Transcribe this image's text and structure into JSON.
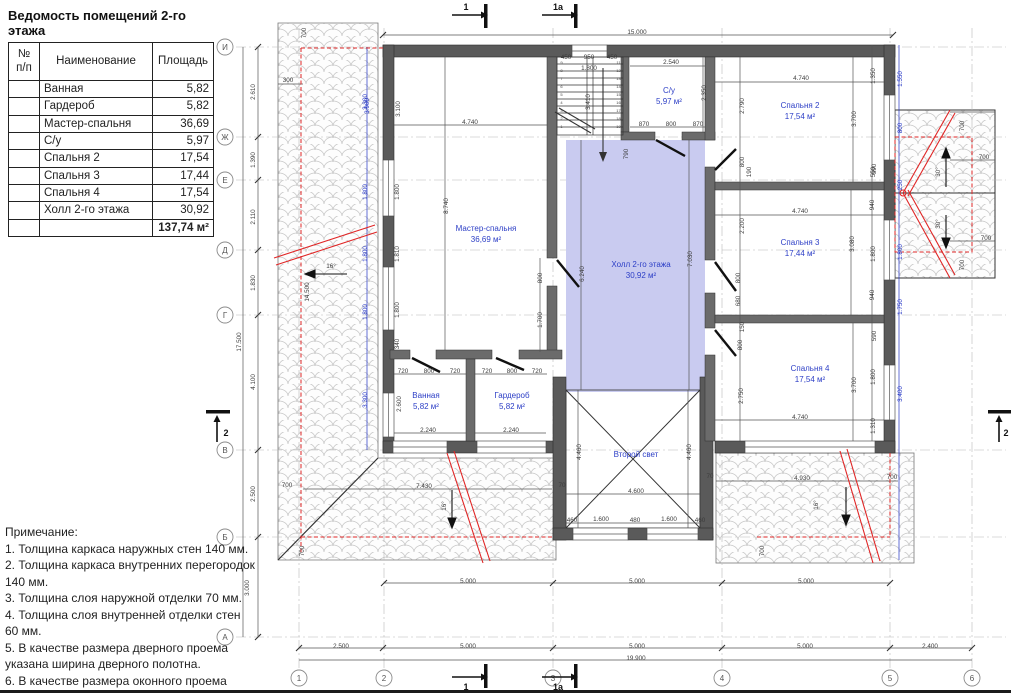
{
  "table": {
    "title": "Ведомость помещений 2-го этажа",
    "header": {
      "no": "№ п/п",
      "name": "Наименование",
      "area": "Площадь"
    },
    "rows": [
      {
        "name": "Ванная",
        "area": "5,82"
      },
      {
        "name": "Гардероб",
        "area": "5,82"
      },
      {
        "name": "Мастер-спальня",
        "area": "36,69"
      },
      {
        "name": "С/у",
        "area": "5,97"
      },
      {
        "name": "Спальня 2",
        "area": "17,54"
      },
      {
        "name": "Спальня 3",
        "area": "17,44"
      },
      {
        "name": "Спальня 4",
        "area": "17,54"
      },
      {
        "name": "Холл 2-го этажа",
        "area": "30,92"
      }
    ],
    "total": "137,74 м²"
  },
  "notes": {
    "title": "Примечание:",
    "items": [
      "1. Толщина каркаса наружных стен 140 мм.",
      "2. Толщина каркаса внутренних перегородок 140 мм.",
      "3. Толщина слоя наружной отделки 70 мм.",
      "4. Толщина слоя внутренней отделки стен 60 мм.",
      "5. В качестве размера дверного проема указана ширина дверного полотна.",
      "6. В качестве размера оконного проема указана ширина оконного блока."
    ]
  },
  "rooms": [
    {
      "name": "Мастер-спальня",
      "area": "36,69 м²"
    },
    {
      "name": "С/у",
      "area": "5,97 м²"
    },
    {
      "name": "Спальня 2",
      "area": "17,54 м²"
    },
    {
      "name": "Спальня 3",
      "area": "17,44 м²"
    },
    {
      "name": "Спальня 4",
      "area": "17,54 м²"
    },
    {
      "name": "Холл 2-го этажа",
      "area": "30,92 м²"
    },
    {
      "name": "Ванная",
      "area": "5,82 м²"
    },
    {
      "name": "Гардероб",
      "area": "5,82 м²"
    },
    {
      "name": "Второй свет",
      "area": ""
    }
  ],
  "axes": {
    "letters": [
      {
        "label": "И",
        "y": 47
      },
      {
        "label": "Ж",
        "y": 137
      },
      {
        "label": "Е",
        "y": 180
      },
      {
        "label": "Д",
        "y": 250
      },
      {
        "label": "Г",
        "y": 315
      },
      {
        "label": "В",
        "y": 450
      },
      {
        "label": "Б",
        "y": 537
      },
      {
        "label": "А",
        "y": 637
      }
    ],
    "numbers": [
      {
        "label": "1",
        "x": 299
      },
      {
        "label": "2",
        "x": 384
      },
      {
        "label": "3",
        "x": 553
      },
      {
        "label": "4",
        "x": 722
      },
      {
        "label": "5",
        "x": 890
      },
      {
        "label": "6",
        "x": 972
      }
    ]
  },
  "markers": [
    {
      "label": "1"
    },
    {
      "label": "1a"
    },
    {
      "label": "1"
    },
    {
      "label": "1a"
    },
    {
      "label": "2"
    },
    {
      "label": "2"
    }
  ],
  "stairs": {
    "left_numbers": [
      "9",
      "8",
      "7",
      "6",
      "5",
      "4",
      "3",
      "2",
      "1"
    ],
    "right_numbers": [
      "11",
      "12",
      "13",
      "14",
      "15",
      "16",
      "17",
      "18",
      "19"
    ]
  },
  "colors": {
    "wall": "#5a5a5a",
    "interior_wall": "#6b6b6b",
    "hall_fill": "#c9cbf0",
    "dim_text": "#3c3c3c",
    "blue_dim": "#2334c4",
    "red": "#e02626",
    "hatch": "#c8c8c8",
    "axis": "#b0b0b0",
    "room_text": "#2c3ec6"
  },
  "dims": [
    {
      "t": "15.000",
      "x": 637,
      "y": 32
    },
    {
      "t": "700",
      "x": 306,
      "y": 31,
      "r": -90
    },
    {
      "t": "300",
      "x": 288,
      "y": 80
    },
    {
      "t": "3.900",
      "x": 369,
      "y": 104,
      "r": -90,
      "c": "b"
    },
    {
      "t": "3.100",
      "x": 400,
      "y": 107,
      "r": -90
    },
    {
      "t": "4.740",
      "x": 470,
      "y": 122
    },
    {
      "t": "450",
      "x": 566,
      "y": 57
    },
    {
      "t": "950",
      "x": 589,
      "y": 57
    },
    {
      "t": "450",
      "x": 612,
      "y": 57
    },
    {
      "t": "1.800",
      "x": 589,
      "y": 68
    },
    {
      "t": "3.410",
      "x": 590,
      "y": 100,
      "r": -90
    },
    {
      "t": "790",
      "x": 628,
      "y": 152,
      "r": -90
    },
    {
      "t": "2.540",
      "x": 671,
      "y": 62
    },
    {
      "t": "2.350",
      "x": 706,
      "y": 91,
      "r": -90
    },
    {
      "t": "870",
      "x": 644,
      "y": 124
    },
    {
      "t": "800",
      "x": 671,
      "y": 124
    },
    {
      "t": "870",
      "x": 698,
      "y": 124
    },
    {
      "t": "4.740",
      "x": 801,
      "y": 78
    },
    {
      "t": "2.790",
      "x": 744,
      "y": 104,
      "r": -90
    },
    {
      "t": "3.700",
      "x": 856,
      "y": 117,
      "r": -90
    },
    {
      "t": "1.350",
      "x": 875,
      "y": 74,
      "r": -90
    },
    {
      "t": "550",
      "x": 875,
      "y": 170,
      "r": -90
    },
    {
      "t": "1.550",
      "x": 902,
      "y": 77,
      "r": -90,
      "c": "b"
    },
    {
      "t": "800",
      "x": 902,
      "y": 126,
      "r": -90,
      "c": "b"
    },
    {
      "t": "250",
      "x": 902,
      "y": 183,
      "r": -90,
      "c": "b"
    },
    {
      "t": "1.800",
      "x": 902,
      "y": 250,
      "r": -90,
      "c": "b"
    },
    {
      "t": "1.750",
      "x": 902,
      "y": 305,
      "r": -90,
      "c": "b"
    },
    {
      "t": "3.400",
      "x": 902,
      "y": 392,
      "r": -90,
      "c": "b"
    },
    {
      "t": "700",
      "x": 964,
      "y": 124,
      "r": -90
    },
    {
      "t": "700",
      "x": 984,
      "y": 157
    },
    {
      "t": "30°",
      "x": 940,
      "y": 170,
      "r": -90
    },
    {
      "t": "30°",
      "x": 940,
      "y": 222,
      "r": -90
    },
    {
      "t": "700",
      "x": 986,
      "y": 238
    },
    {
      "t": "700",
      "x": 964,
      "y": 263,
      "r": -90
    },
    {
      "t": "2.610",
      "x": 255,
      "y": 90,
      "r": -90
    },
    {
      "t": "1.390",
      "x": 255,
      "y": 158,
      "r": -90
    },
    {
      "t": "2.110",
      "x": 255,
      "y": 215,
      "r": -90
    },
    {
      "t": "1.830",
      "x": 255,
      "y": 281,
      "r": -90
    },
    {
      "t": "17.500",
      "x": 241,
      "y": 340,
      "r": -90
    },
    {
      "t": "4.100",
      "x": 255,
      "y": 380,
      "r": -90
    },
    {
      "t": "2.500",
      "x": 255,
      "y": 492,
      "r": -90
    },
    {
      "t": "3.000",
      "x": 249,
      "y": 586,
      "r": -90
    },
    {
      "t": "3.300",
      "x": 367,
      "y": 100,
      "r": -90,
      "c": "b"
    },
    {
      "t": "1.800",
      "x": 367,
      "y": 190,
      "r": -90,
      "c": "b"
    },
    {
      "t": "1.800",
      "x": 367,
      "y": 252,
      "r": -90,
      "c": "b"
    },
    {
      "t": "1.800",
      "x": 367,
      "y": 310,
      "r": -90,
      "c": "b"
    },
    {
      "t": "3.300",
      "x": 367,
      "y": 398,
      "r": -90,
      "c": "b"
    },
    {
      "t": "1.800",
      "x": 399,
      "y": 190,
      "r": -90
    },
    {
      "t": "1.810",
      "x": 399,
      "y": 252,
      "r": -90
    },
    {
      "t": "1.800",
      "x": 399,
      "y": 308,
      "r": -90
    },
    {
      "t": "340",
      "x": 399,
      "y": 342,
      "r": -90
    },
    {
      "t": "14.500",
      "x": 309,
      "y": 290,
      "r": -90
    },
    {
      "t": "16°",
      "x": 331,
      "y": 266
    },
    {
      "t": "8.740",
      "x": 448,
      "y": 204,
      "r": -90
    },
    {
      "t": "800",
      "x": 542,
      "y": 276,
      "r": -90
    },
    {
      "t": "1.700",
      "x": 542,
      "y": 318,
      "r": -90
    },
    {
      "t": "6.240",
      "x": 584,
      "y": 272,
      "r": -90
    },
    {
      "t": "7.030",
      "x": 692,
      "y": 257,
      "r": -90
    },
    {
      "t": "720",
      "x": 403,
      "y": 371
    },
    {
      "t": "800",
      "x": 429,
      "y": 371
    },
    {
      "t": "720",
      "x": 455,
      "y": 371
    },
    {
      "t": "720",
      "x": 487,
      "y": 371
    },
    {
      "t": "800",
      "x": 512,
      "y": 371
    },
    {
      "t": "720",
      "x": 537,
      "y": 371
    },
    {
      "t": "2.600",
      "x": 401,
      "y": 402,
      "r": -90
    },
    {
      "t": "2.240",
      "x": 428,
      "y": 430
    },
    {
      "t": "2.240",
      "x": 511,
      "y": 430
    },
    {
      "t": "800",
      "x": 744,
      "y": 160,
      "r": -90
    },
    {
      "t": "190",
      "x": 751,
      "y": 170,
      "r": -90
    },
    {
      "t": "4.740",
      "x": 800,
      "y": 211
    },
    {
      "t": "2.200",
      "x": 744,
      "y": 224,
      "r": -90
    },
    {
      "t": "800",
      "x": 740,
      "y": 276,
      "r": -90
    },
    {
      "t": "680",
      "x": 740,
      "y": 299,
      "r": -90
    },
    {
      "t": "3.080",
      "x": 854,
      "y": 242,
      "r": -90
    },
    {
      "t": "590",
      "x": 876,
      "y": 167,
      "r": -90
    },
    {
      "t": "940",
      "x": 874,
      "y": 203,
      "r": -90
    },
    {
      "t": "1.800",
      "x": 875,
      "y": 252,
      "r": -90
    },
    {
      "t": "940",
      "x": 874,
      "y": 293,
      "r": -90
    },
    {
      "t": "150",
      "x": 744,
      "y": 325,
      "r": -90
    },
    {
      "t": "800",
      "x": 742,
      "y": 343,
      "r": -90
    },
    {
      "t": "2.750",
      "x": 743,
      "y": 394,
      "r": -90
    },
    {
      "t": "3.700",
      "x": 856,
      "y": 383,
      "r": -90
    },
    {
      "t": "590",
      "x": 876,
      "y": 334,
      "r": -90
    },
    {
      "t": "1.800",
      "x": 875,
      "y": 375,
      "r": -90
    },
    {
      "t": "1.310",
      "x": 875,
      "y": 424,
      "r": -90
    },
    {
      "t": "4.740",
      "x": 800,
      "y": 417
    },
    {
      "t": "4.460",
      "x": 581,
      "y": 450,
      "r": -90
    },
    {
      "t": "4.460",
      "x": 691,
      "y": 450,
      "r": -90
    },
    {
      "t": "4.600",
      "x": 636,
      "y": 491
    },
    {
      "t": "460",
      "x": 572,
      "y": 520
    },
    {
      "t": "1.600",
      "x": 601,
      "y": 519
    },
    {
      "t": "480",
      "x": 635,
      "y": 520
    },
    {
      "t": "1.600",
      "x": 669,
      "y": 519
    },
    {
      "t": "460",
      "x": 700,
      "y": 520
    },
    {
      "t": "70",
      "x": 562,
      "y": 485
    },
    {
      "t": "70",
      "x": 710,
      "y": 476
    },
    {
      "t": "7.430",
      "x": 424,
      "y": 486
    },
    {
      "t": "16°",
      "x": 446,
      "y": 504,
      "r": -90
    },
    {
      "t": "700",
      "x": 287,
      "y": 485
    },
    {
      "t": "700",
      "x": 304,
      "y": 549,
      "r": -90
    },
    {
      "t": "4.930",
      "x": 802,
      "y": 478
    },
    {
      "t": "700",
      "x": 892,
      "y": 477
    },
    {
      "t": "16°",
      "x": 818,
      "y": 503,
      "r": -90
    },
    {
      "t": "700",
      "x": 764,
      "y": 549,
      "r": -90
    },
    {
      "t": "5.000",
      "x": 468,
      "y": 581
    },
    {
      "t": "5.000",
      "x": 637,
      "y": 581
    },
    {
      "t": "5.000",
      "x": 806,
      "y": 581
    },
    {
      "t": "2.500",
      "x": 341,
      "y": 646
    },
    {
      "t": "5.000",
      "x": 468,
      "y": 646
    },
    {
      "t": "5.000",
      "x": 637,
      "y": 646
    },
    {
      "t": "5.000",
      "x": 805,
      "y": 646
    },
    {
      "t": "2.400",
      "x": 930,
      "y": 646
    },
    {
      "t": "19.900",
      "x": 636,
      "y": 658
    }
  ]
}
